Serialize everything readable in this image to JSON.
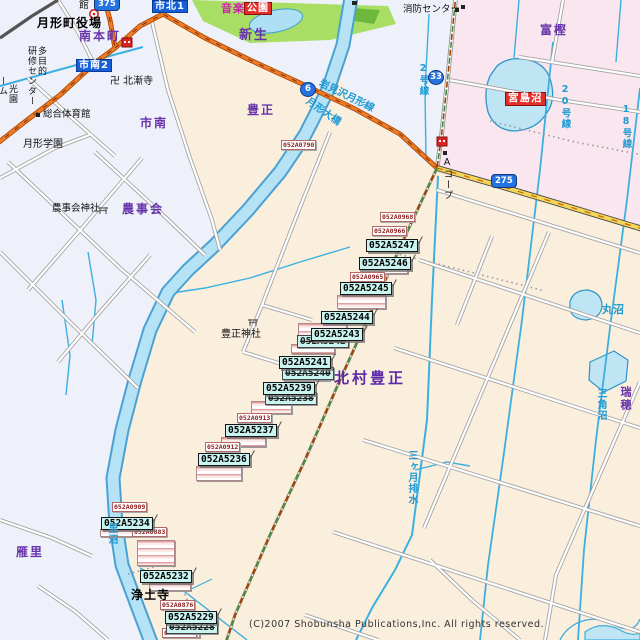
{
  "map": {
    "copyright": "(C)2007 Shobunsha Publications,Inc. All rights reserved.",
    "colors": {
      "land_rural": "#faeedd",
      "land_urban": "#eff1fa",
      "land_pink": "#f9e6ee",
      "park_green": "#a9de65",
      "water_fill": "#b5e2f5",
      "water_line": "#4aa2d4",
      "canal_line": "#3bb0e0",
      "road_orange": "#ee7b28",
      "road_yellow": "#f3d558",
      "boundary_green": "#3e8e3e",
      "boundary_brown": "#a04000",
      "code_label_bg": "#c9f4ef",
      "ref_text": "#8b1d1d",
      "area_text": "#6633aa",
      "water_text": "#1f9ad2",
      "selected_bg": "#e62e28",
      "district_box_bg": "#1560d8"
    },
    "stacks": [
      {
        "x": 360,
        "y": 266,
        "w": 46,
        "h": 6
      },
      {
        "x": 337,
        "y": 295,
        "w": 47,
        "h": 12
      },
      {
        "x": 298,
        "y": 323,
        "w": 47,
        "h": 13
      },
      {
        "x": 291,
        "y": 344,
        "w": 42,
        "h": 8
      },
      {
        "x": 283,
        "y": 371,
        "w": 45,
        "h": 8
      },
      {
        "x": 251,
        "y": 401,
        "w": 39,
        "h": 11
      },
      {
        "x": 221,
        "y": 437,
        "w": 43,
        "h": 8
      },
      {
        "x": 196,
        "y": 466,
        "w": 44,
        "h": 13
      },
      {
        "x": 100,
        "y": 529,
        "w": 40,
        "h": 6
      },
      {
        "x": 137,
        "y": 540,
        "w": 36,
        "h": 24
      },
      {
        "x": 149,
        "y": 583,
        "w": 40,
        "h": 6
      },
      {
        "x": 167,
        "y": 630,
        "w": 31,
        "h": 6
      }
    ],
    "labels": [
      {
        "n": "ref-label-052A0790",
        "c": "ref",
        "t": "052A0790",
        "x": 281,
        "y": 140
      },
      {
        "n": "ref-label-052A0968",
        "c": "ref",
        "t": "052A0968",
        "x": 380,
        "y": 212
      },
      {
        "n": "ref-label-052A0966",
        "c": "ref",
        "t": "052A0966",
        "x": 372,
        "y": 226
      },
      {
        "n": "ref-label-052A0965",
        "c": "ref",
        "t": "052A0965",
        "x": 350,
        "y": 272
      },
      {
        "n": "ref-label-052A0913",
        "c": "ref",
        "t": "052A0913",
        "x": 237,
        "y": 413
      },
      {
        "n": "ref-label-052A0912",
        "c": "ref",
        "t": "052A0912",
        "x": 205,
        "y": 442
      },
      {
        "n": "ref-label-052A0909",
        "c": "ref",
        "t": "052A0909",
        "x": 112,
        "y": 502
      },
      {
        "n": "ref-label-052A0883",
        "c": "ref",
        "t": "052A0883",
        "x": 132,
        "y": 527
      },
      {
        "n": "ref-label-052A0876",
        "c": "ref",
        "t": "052A0876",
        "x": 160,
        "y": 600
      },
      {
        "n": "ref-label-052A0871",
        "c": "ref",
        "t": "052A0871",
        "x": 162,
        "y": 628
      },
      {
        "n": "code-label-052A5247",
        "c": "code",
        "t": "052A5247",
        "x": 366,
        "y": 239
      },
      {
        "n": "code-label-052A5246",
        "c": "code",
        "t": "052A5246",
        "x": 359,
        "y": 257
      },
      {
        "n": "code-label-052A5245",
        "c": "code",
        "t": "052A5245",
        "x": 340,
        "y": 282
      },
      {
        "n": "code-label-052A5244",
        "c": "code",
        "t": "052A5244",
        "x": 321,
        "y": 311
      },
      {
        "n": "code-label-ghost-052A5242",
        "c": "ghost",
        "t": "052A5242",
        "x": 297,
        "y": 335
      },
      {
        "n": "code-label-052A5243",
        "c": "code",
        "t": "052A5243",
        "x": 311,
        "y": 328
      },
      {
        "n": "code-label-ghost-052A5240",
        "c": "ghost",
        "t": "052A5240",
        "x": 282,
        "y": 367
      },
      {
        "n": "code-label-052A5241",
        "c": "code",
        "t": "052A5241",
        "x": 279,
        "y": 356
      },
      {
        "n": "code-label-ghost-052A5238",
        "c": "ghost",
        "t": "052A5238",
        "x": 265,
        "y": 392
      },
      {
        "n": "code-label-052A5239",
        "c": "code",
        "t": "052A5239",
        "x": 263,
        "y": 382
      },
      {
        "n": "code-label-052A5237",
        "c": "code",
        "t": "052A5237",
        "x": 225,
        "y": 424
      },
      {
        "n": "code-label-052A5236",
        "c": "code",
        "t": "052A5236",
        "x": 198,
        "y": 453
      },
      {
        "n": "code-label-052A5234",
        "c": "code",
        "t": "052A5234",
        "x": 101,
        "y": 517
      },
      {
        "n": "code-label-052A5232",
        "c": "code",
        "t": "052A5232",
        "x": 140,
        "y": 570
      },
      {
        "n": "code-label-ghost-052A5228",
        "c": "ghost",
        "t": "052A5228",
        "x": 166,
        "y": 621
      },
      {
        "n": "code-label-052A5229",
        "c": "code",
        "t": "052A5229",
        "x": 165,
        "y": 611
      },
      {
        "n": "area-label-minamihoncho",
        "c": "area",
        "t": "南本町",
        "x": 79,
        "y": 30
      },
      {
        "n": "area-label-shinsei",
        "c": "area",
        "t": "新生",
        "x": 239,
        "y": 29,
        "fs": 13
      },
      {
        "n": "area-label-toyomasa",
        "c": "area",
        "t": "豊正",
        "x": 247,
        "y": 104
      },
      {
        "n": "area-label-shinami",
        "c": "area",
        "t": "市南",
        "x": 140,
        "y": 117
      },
      {
        "n": "area-label-togashi",
        "c": "area",
        "t": "富樫",
        "x": 540,
        "y": 24
      },
      {
        "n": "area-label-nojikai",
        "c": "area",
        "t": "農事会",
        "x": 122,
        "y": 203
      },
      {
        "n": "area-label-kitamura-toyomasa",
        "c": "areab",
        "t": "北村豊正",
        "x": 334,
        "y": 370
      },
      {
        "n": "area-label-karisato",
        "c": "area",
        "t": "雁里",
        "x": 16,
        "y": 546
      },
      {
        "n": "area-label-mizuho",
        "c": "area",
        "t": "瑞穂",
        "x": 620,
        "y": 386,
        "v": 1,
        "fs": 11
      },
      {
        "n": "poi-label-tsukigata-town-hall",
        "c": "poib",
        "t": "月形町役場",
        "x": 37,
        "y": 17
      },
      {
        "n": "poi-label-kan",
        "c": "poi",
        "t": "館",
        "x": 79,
        "y": 0
      },
      {
        "n": "poi-label-hokuzenji-temple",
        "c": "poi",
        "t": "卍 北漸寺",
        "x": 110,
        "y": 76
      },
      {
        "n": "poi-label-sogo-taiikukan",
        "c": "poi",
        "t": "総合体育館",
        "x": 43,
        "y": 110,
        "fs": 9.5
      },
      {
        "n": "poi-label-tsukigata-gakuen",
        "c": "poi",
        "t": "月形学園",
        "x": 23,
        "y": 139
      },
      {
        "n": "poi-label-tamokuteki",
        "c": "poi",
        "t": "多目的",
        "x": 36,
        "y": 46,
        "v": 1,
        "fs": 9
      },
      {
        "n": "poi-label-kenshu-center",
        "c": "poi",
        "t": "研修センター",
        "x": 26,
        "y": 46,
        "v": 1,
        "fs": 9
      },
      {
        "n": "poi-label-koen-partial",
        "c": "poi",
        "t": "光園",
        "x": 7,
        "y": 84,
        "v": 1,
        "fs": 9
      },
      {
        "n": "poi-label-mu-partial",
        "c": "poi",
        "t": "ーム",
        "x": -3,
        "y": 76,
        "v": 1,
        "fs": 9
      },
      {
        "n": "poi-label-shobo-center",
        "c": "poi",
        "t": "消防センター",
        "x": 403,
        "y": 5,
        "fs": 9.5
      },
      {
        "n": "poi-label-a-coop",
        "c": "poi",
        "t": "Aコープ",
        "x": 442,
        "y": 157,
        "v": 1,
        "fs": 9.5
      },
      {
        "n": "poi-label-toyomasa-shrine",
        "c": "poi",
        "t": "豊正神社",
        "x": 221,
        "y": 329
      },
      {
        "n": "poi-label-nojikai-shrine",
        "c": "poi",
        "t": "農事会神社",
        "x": 52,
        "y": 204,
        "fs": 9.5
      },
      {
        "n": "poi-label-jodoji-temple",
        "c": "poib",
        "t": "浄土寺",
        "x": 131,
        "y": 589
      },
      {
        "n": "water-label-tsukigata-ohashi",
        "c": "water",
        "t": "月形大橋",
        "x": 310,
        "y": 96,
        "rot": 35
      },
      {
        "n": "water-label-iwamizawa-tsukigata-line",
        "c": "water",
        "t": "岩見沢月形線",
        "x": 322,
        "y": 78,
        "rot": 26
      },
      {
        "n": "water-label-marunuma",
        "c": "water",
        "t": "丸沼",
        "x": 602,
        "y": 304,
        "fs": 11
      },
      {
        "n": "water-label-sankakunuma",
        "c": "water",
        "t": "三角沼",
        "x": 595,
        "y": 388,
        "v": 1
      },
      {
        "n": "water-label-mikazuki-haisui",
        "c": "water",
        "t": "三ヶ月排水",
        "x": 406,
        "y": 450,
        "v": 1
      },
      {
        "n": "water-label-2-gosen",
        "c": "water",
        "t": "2号線",
        "x": 418,
        "y": 63,
        "v": 1,
        "fs": 9.5
      },
      {
        "n": "water-label-20-gosen",
        "c": "water",
        "t": "20号線",
        "x": 560,
        "y": 84,
        "v": 1,
        "fs": 9.5
      },
      {
        "n": "water-label-18-gosen",
        "c": "water",
        "t": "18号線",
        "x": 621,
        "y": 104,
        "v": 1,
        "fs": 9.5
      },
      {
        "n": "water-label-satonuma",
        "c": "water",
        "t": "里沼",
        "x": 106,
        "y": 523,
        "v": 1
      },
      {
        "n": "district-box-ichikita1",
        "c": "bluebox",
        "t": "市北1",
        "x": 152,
        "y": 0
      },
      {
        "n": "district-box-ichinami2",
        "c": "bluebox",
        "t": "市南2",
        "x": 76,
        "y": 59
      },
      {
        "n": "selected-label-miyajimanuma",
        "c": "redbox",
        "t": "宮島沼",
        "x": 505,
        "y": 92
      },
      {
        "n": "selected-label-koen",
        "c": "redbox",
        "t": "公園",
        "x": 244,
        "y": 2,
        "fs": 10
      },
      {
        "n": "poi-label-ongaku",
        "c": "mag",
        "t": "音楽",
        "x": 221,
        "y": 3
      },
      {
        "n": "route-shield-375",
        "c": "shr",
        "t": "375",
        "x": 94,
        "y": -3
      },
      {
        "n": "route-shield-6",
        "c": "shc",
        "t": "6",
        "x": 300,
        "y": 82
      },
      {
        "n": "route-shield-33",
        "c": "shc",
        "t": "33",
        "x": 428,
        "y": 70
      },
      {
        "n": "route-shield-275",
        "c": "shr",
        "t": "275",
        "x": 491,
        "y": 174
      }
    ]
  }
}
